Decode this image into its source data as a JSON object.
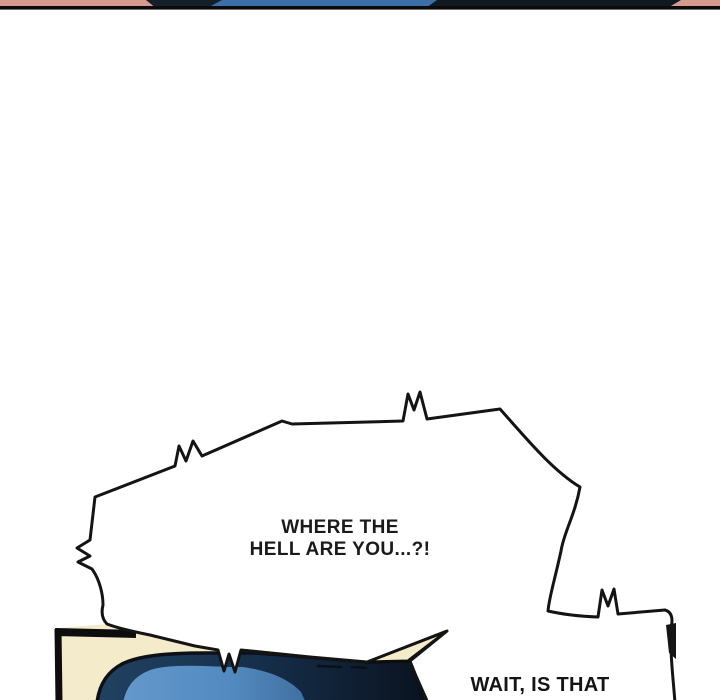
{
  "comic": {
    "speech_bubble": {
      "line1": "WHERE THE",
      "line2": "HELL ARE YOU...?!"
    },
    "caption": {
      "text": "WAIT, IS THAT"
    }
  },
  "colors": {
    "page_background": "#ffffff",
    "ink_outline": "#141414",
    "top_strip_salmon": "#d69b8e",
    "top_strip_blue": "#3c6fa8",
    "top_strip_navy": "#141f2c",
    "top_strip_rule": "#0b0b0b",
    "panel_border": "#0d0d0d",
    "panel_cream": "#f4ebca",
    "panel_navy_light": "#20405f",
    "panel_navy_dark": "#0a1320",
    "panel_blue_light": "#6399cc",
    "panel_blue_dark": "#3f6e9e",
    "text_ink": "#1a1a1a"
  }
}
